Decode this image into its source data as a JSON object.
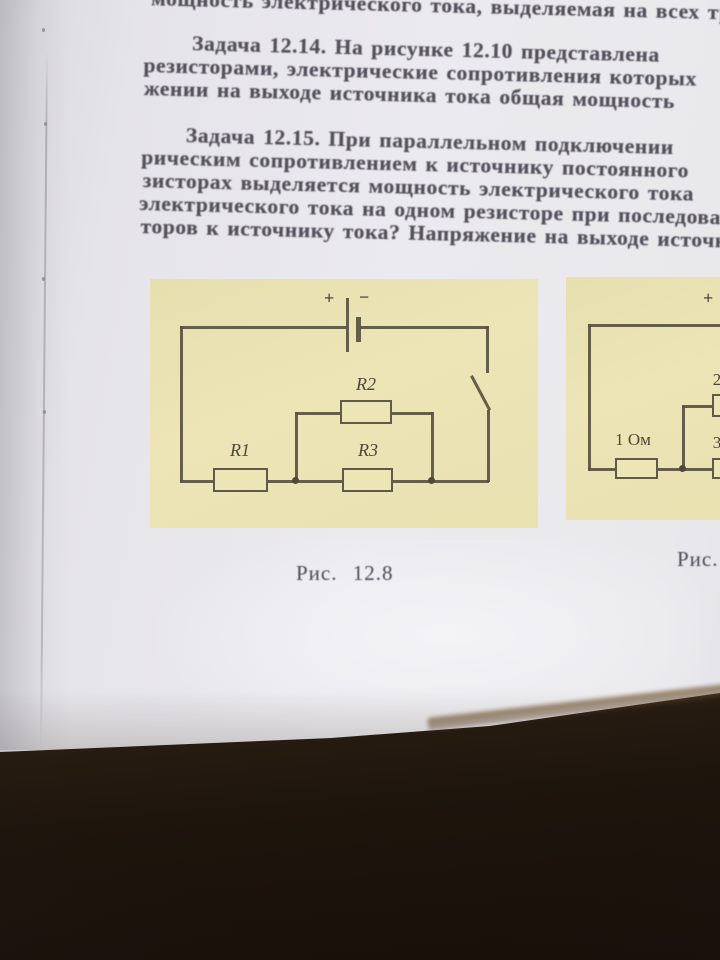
{
  "page": {
    "top_line": "мощность электрического тока, выделяемая на всех трех резисторах",
    "p14": {
      "label": "Задача 12.14.",
      "l1": "На рисунке 12.10 представлена",
      "l2": "резисторами, электрические сопротивления которых",
      "l3": "жении на выходе источника тока общая мощность"
    },
    "p15": {
      "label": "Задача 12.15.",
      "l1": "При параллельном подключении",
      "l2": "рическим сопротивлением к источнику постоянного",
      "l3": "зисторах выделяется мощность электрического тока",
      "l4": "электрического тока на одном резисторе при последовательном",
      "l5": "торов к источнику тока? Напряжение на выходе источника"
    }
  },
  "fig_left": {
    "caption": "Рис. 12.8",
    "battery_plus": "+",
    "battery_minus": "−",
    "r1": "R1",
    "r2": "R2",
    "r3": "R3"
  },
  "fig_right": {
    "caption": "Рис.",
    "battery_plus": "+",
    "resistor_1_label": "1 Ом",
    "label_2": "2",
    "label_3": "3"
  },
  "colors": {
    "paper": "#e6e5e9",
    "figure_background": "#e9e2b2",
    "circuit_ink": "#585242",
    "text_ink": "#534f5a",
    "table_dark": "#1e150d",
    "table_highlight": "#78583480"
  }
}
